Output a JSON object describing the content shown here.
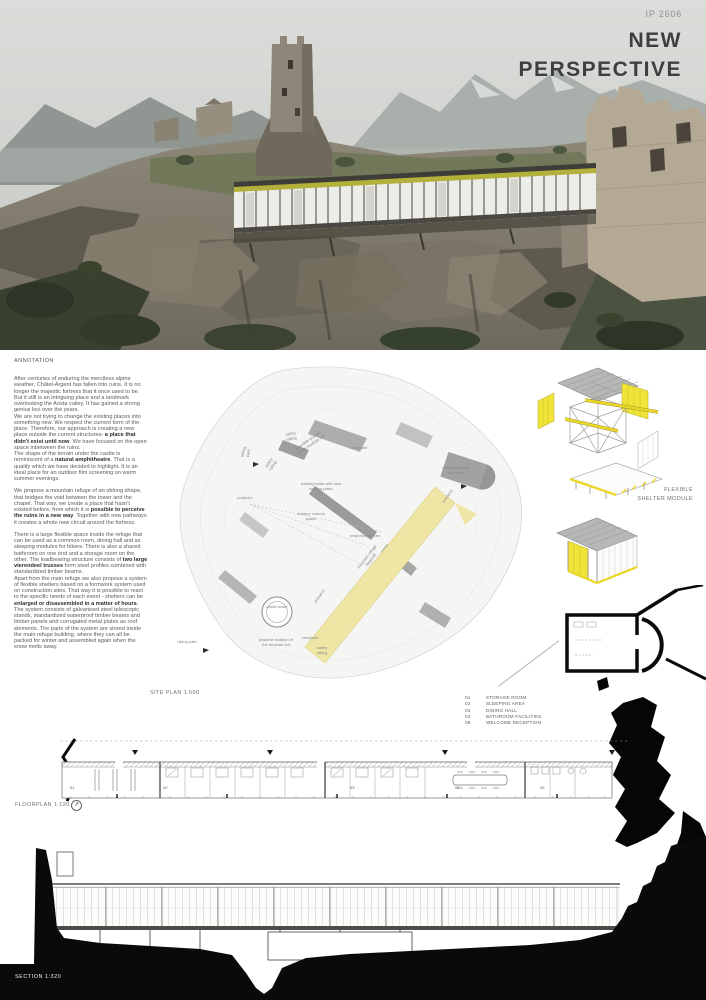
{
  "colors": {
    "accent_yellow": "#f0e438",
    "site_band_yellow": "#efe6a6",
    "fascia_olive": "#b2b13a",
    "roof_grey": "#b8b8b8",
    "ink": "#3d3e40"
  },
  "header": {
    "project_id": "IP 2606",
    "title_line1": "NEW",
    "title_line2": "PERSPECTIVE"
  },
  "annotation": {
    "heading": "ANNOTATION",
    "paragraphs": [
      {
        "segments": [
          {
            "t": "After centuries of enduring the merciless alpine weather, Châtel-Argent has fallen into ruins. It is no longer the majestic fortress that it once used to be. But it still is an intriguing place and a landmark overlooking the Aosta valley. It has gained a strong genius loci over the years."
          }
        ]
      },
      {
        "segments": [
          {
            "t": "We are not trying to change the existing places into something new. We respect the current form of the place. Therefore, our approach is creating a new place outside the current structures- "
          },
          {
            "t": "a place that didn't exist until now",
            "b": true
          },
          {
            "t": ". We have focused on the open space inbetween the ruins."
          }
        ]
      },
      {
        "segments": [
          {
            "t": "The shape of the terrain under the castle is reminiscent of a "
          },
          {
            "t": "natural amphitheatre",
            "b": true
          },
          {
            "t": ". That is a quality which we have decided to highlight. It is an ideal place for an outdoor film screening on warm summer evenings."
          }
        ]
      },
      {
        "segments": [
          {
            "t": "We propose a mountain refuge of an oblong shape, that bridges the void between the tower and the chapel. That way, we create a place that hasn't existed before, from which it is "
          },
          {
            "t": "possible to perceive the ruins in a new way",
            "b": true
          },
          {
            "t": ". Together with new pathways it creates a whole new circuit around the fortress."
          }
        ]
      },
      {
        "segments": [
          {
            "t": "There is a large flexible space inside the refuge that can be used as a common room, dining hall and as sleeping modules for hikers. There is also a shared bathroom on one end and a storage room on the other. The loadbearing structure consists of "
          },
          {
            "t": "two large vierendeel trusses",
            "b": true
          },
          {
            "t": " form steel profiles combined with standardized timber beams."
          }
        ]
      },
      {
        "segments": [
          {
            "t": "Apart from the main refuge we also propose a system of flexible shelters based on a formwork system used on construction sites. That way it is possible to react to the specific needs of each event - shelters can be "
          },
          {
            "t": "enlarged or disassembled in a matter of hours",
            "b": true
          },
          {
            "t": ". The system consists of galvanised steel telescopic stands, standardized waterproof timber beams and timber panels and corrugated metal plates as roof elements. The parts of the system are stored inside the main refuge building, where they can all be packed for winter and assembled again when the snow melts away."
          }
        ]
      }
    ]
  },
  "site_plan": {
    "label": "SITE PLAN 1:500",
    "labels": [
      {
        "text": "hiking path"
      },
      {
        "text": "safety railing"
      },
      {
        "text": "possible location of the modular hut"
      },
      {
        "text": "viewpoint"
      },
      {
        "text": "safety railing"
      },
      {
        "text": "chapel welcome reception"
      },
      {
        "text": "existing walls with new seating place"
      },
      {
        "text": "projector"
      },
      {
        "text": "outdoor cinema space"
      },
      {
        "text": "projection screen"
      },
      {
        "text": "mountain refuge (legend)"
      },
      {
        "text": "entrance"
      },
      {
        "text": "castle tower"
      },
      {
        "text": "possible location of the modular hut"
      },
      {
        "text": "viewpoint"
      },
      {
        "text": "safety railing"
      },
      {
        "text": "hiking path"
      },
      {
        "text": "entrance"
      }
    ]
  },
  "shelter_module": {
    "label_line1": "FLEXIBLE",
    "label_line2": "SHELTER MODULE"
  },
  "legend": {
    "items": [
      {
        "num": "01",
        "label": "STORAGE ROOM"
      },
      {
        "num": "02",
        "label": "SLEEPING AREA"
      },
      {
        "num": "03",
        "label": "DINING HALL"
      },
      {
        "num": "04",
        "label": "BATHROOM FACILITIES"
      },
      {
        "num": "05",
        "label": "WELCOME RECEPTION"
      }
    ]
  },
  "floorplan": {
    "label": "FLOORPLAN 1:120",
    "rooms": [
      "01",
      "02",
      "03",
      "04",
      "05"
    ]
  },
  "section": {
    "label": "SECTION 1:320"
  }
}
